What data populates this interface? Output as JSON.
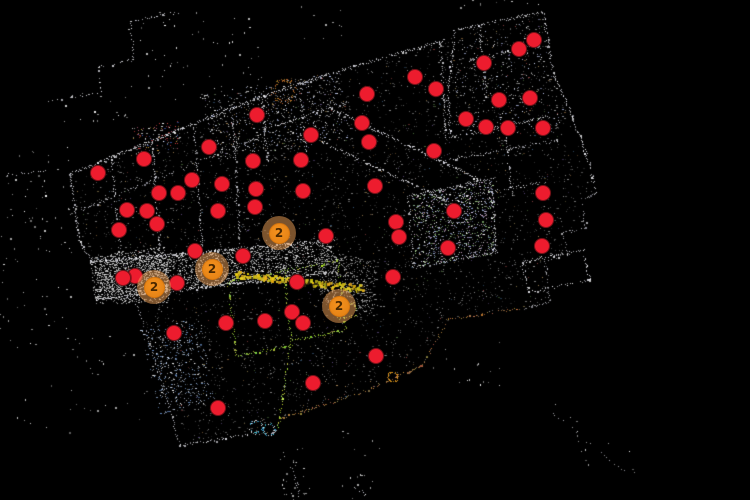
{
  "view": {
    "title": "point-cloud-floor-map",
    "width": 750,
    "height": 500,
    "background_color": "#000000"
  },
  "markers": {
    "poi_fill": "#ed1c2e",
    "poi_border": "#7a1219",
    "cluster_halo": "rgba(246,166,90,0.5)",
    "cluster_fill_inner": "#f6921e",
    "cluster_fill_edge": "#e07f14",
    "cluster_border": "#d8760d",
    "cluster_text_color": "#4a2800",
    "pois": [
      [
        534,
        40
      ],
      [
        519,
        49
      ],
      [
        484,
        63
      ],
      [
        415,
        77
      ],
      [
        436,
        89
      ],
      [
        367,
        94
      ],
      [
        530,
        98
      ],
      [
        499,
        100
      ],
      [
        257,
        115
      ],
      [
        466,
        119
      ],
      [
        362,
        123
      ],
      [
        486,
        127
      ],
      [
        508,
        128
      ],
      [
        543,
        128
      ],
      [
        311,
        135
      ],
      [
        369,
        142
      ],
      [
        209,
        147
      ],
      [
        434,
        151
      ],
      [
        144,
        159
      ],
      [
        301,
        160
      ],
      [
        253,
        161
      ],
      [
        98,
        173
      ],
      [
        192,
        180
      ],
      [
        222,
        184
      ],
      [
        375,
        186
      ],
      [
        256,
        189
      ],
      [
        303,
        191
      ],
      [
        543,
        193
      ],
      [
        159,
        193
      ],
      [
        178,
        193
      ],
      [
        255,
        207
      ],
      [
        454,
        211
      ],
      [
        127,
        210
      ],
      [
        147,
        211
      ],
      [
        218,
        211
      ],
      [
        546,
        220
      ],
      [
        396,
        222
      ],
      [
        157,
        224
      ],
      [
        119,
        230
      ],
      [
        326,
        236
      ],
      [
        399,
        237
      ],
      [
        542,
        246
      ],
      [
        448,
        248
      ],
      [
        195,
        251
      ],
      [
        243,
        256
      ],
      [
        135,
        276
      ],
      [
        123,
        278
      ],
      [
        393,
        277
      ],
      [
        177,
        283
      ],
      [
        297,
        282
      ],
      [
        292,
        312
      ],
      [
        303,
        323
      ],
      [
        226,
        323
      ],
      [
        265,
        321
      ],
      [
        174,
        333
      ],
      [
        313,
        383
      ],
      [
        376,
        356
      ],
      [
        218,
        408
      ]
    ],
    "clusters": [
      {
        "x": 279,
        "y": 233,
        "count": "2"
      },
      {
        "x": 212,
        "y": 269,
        "count": "2"
      },
      {
        "x": 154,
        "y": 287,
        "count": "2"
      },
      {
        "x": 339,
        "y": 306,
        "count": "2"
      }
    ]
  },
  "point_cloud": {
    "seed": 1337,
    "outline": [
      [
        70,
        174
      ],
      [
        255,
        99
      ],
      [
        338,
        71
      ],
      [
        445,
        40
      ],
      [
        455,
        30
      ],
      [
        543,
        12
      ],
      [
        553,
        72
      ],
      [
        572,
        115
      ],
      [
        596,
        195
      ],
      [
        580,
        199
      ],
      [
        586,
        228
      ],
      [
        562,
        233
      ],
      [
        568,
        255
      ],
      [
        545,
        260
      ],
      [
        550,
        302
      ],
      [
        522,
        309
      ],
      [
        448,
        320
      ],
      [
        422,
        366
      ],
      [
        358,
        394
      ],
      [
        280,
        419
      ],
      [
        278,
        431
      ],
      [
        180,
        445
      ],
      [
        158,
        370
      ],
      [
        130,
        284
      ],
      [
        94,
        300
      ],
      [
        90,
        262
      ],
      [
        80,
        242
      ]
    ],
    "walls": [
      {
        "p": [
          [
            70,
            174
          ],
          [
            255,
            99
          ],
          [
            338,
            71
          ],
          [
            445,
            40
          ]
        ],
        "d": 1.3,
        "b": [
          170,
          255
        ]
      },
      {
        "p": [
          [
            70,
            174
          ],
          [
            80,
            242
          ],
          [
            92,
            262
          ]
        ],
        "d": 1.2
      },
      {
        "p": [
          [
            455,
            30
          ],
          [
            543,
            12
          ],
          [
            553,
            72
          ],
          [
            572,
            115
          ],
          [
            590,
            165
          ],
          [
            596,
            195
          ]
        ],
        "d": 1.1
      },
      {
        "p": [
          [
            596,
            195
          ],
          [
            580,
            199
          ],
          [
            586,
            228
          ],
          [
            562,
            233
          ],
          [
            568,
            255
          ],
          [
            545,
            260
          ],
          [
            550,
            302
          ],
          [
            522,
            309
          ]
        ],
        "d": 0.8,
        "b": [
          120,
          210
        ]
      },
      {
        "p": [
          [
            455,
            30
          ],
          [
            448,
            95
          ],
          [
            450,
            138
          ]
        ]
      },
      {
        "p": [
          [
            450,
            138
          ],
          [
            552,
            116
          ]
        ]
      },
      {
        "p": [
          [
            440,
            42
          ],
          [
            446,
            140
          ]
        ],
        "d": 0.9
      },
      {
        "p": [
          [
            438,
            162
          ],
          [
            560,
            140
          ]
        ],
        "d": 0.8
      },
      {
        "p": [
          [
            330,
            108
          ],
          [
            480,
            180
          ]
        ],
        "d": 1.4,
        "b": [
          180,
          255
        ]
      },
      {
        "p": [
          [
            322,
            142
          ],
          [
            462,
            208
          ]
        ],
        "d": 1.2,
        "b": [
          170,
          255
        ]
      },
      {
        "p": [
          [
            90,
            262
          ],
          [
            335,
            240
          ]
        ],
        "d": 1.4,
        "b": [
          180,
          255
        ]
      },
      {
        "p": [
          [
            94,
            300
          ],
          [
            338,
            272
          ]
        ],
        "d": 1.4,
        "b": [
          180,
          255
        ]
      },
      {
        "p": [
          [
            130,
            284
          ],
          [
            158,
            370
          ],
          [
            180,
            445
          ]
        ],
        "d": 0.7,
        "b": [
          130,
          220
        ]
      },
      {
        "p": [
          [
            180,
            445
          ],
          [
            278,
            431
          ]
        ],
        "d": 0.9
      },
      {
        "p": [
          [
            112,
            158
          ],
          [
            120,
            253
          ]
        ],
        "d": 0.9
      },
      {
        "p": [
          [
            152,
            142
          ],
          [
            160,
            250
          ]
        ],
        "d": 0.9
      },
      {
        "p": [
          [
            194,
            125
          ],
          [
            202,
            247
          ]
        ],
        "d": 0.9
      },
      {
        "p": [
          [
            232,
            108
          ],
          [
            240,
            244
          ]
        ],
        "d": 0.9
      },
      {
        "p": [
          [
            75,
            212
          ],
          [
            258,
            138
          ]
        ],
        "d": 0.8,
        "b": [
          130,
          220
        ]
      },
      {
        "p": [
          [
            262,
            100
          ],
          [
            268,
            162
          ]
        ],
        "d": 0.9
      },
      {
        "p": [
          [
            300,
            88
          ],
          [
            306,
            152
          ]
        ],
        "d": 0.8
      },
      {
        "p": [
          [
            262,
            130
          ],
          [
            348,
            102
          ]
        ],
        "d": 0.8
      },
      {
        "p": [
          [
            410,
            196
          ],
          [
            493,
            179
          ]
        ],
        "d": 1.1
      },
      {
        "p": [
          [
            490,
            179
          ],
          [
            497,
            254
          ]
        ],
        "d": 1.0
      },
      {
        "p": [
          [
            412,
            268
          ],
          [
            494,
            252
          ]
        ],
        "d": 0.9
      },
      {
        "p": [
          [
            408,
            196
          ],
          [
            414,
            268
          ]
        ],
        "d": 0.8
      },
      {
        "p": [
          [
            505,
            130
          ],
          [
            512,
            196
          ]
        ],
        "d": 0.8
      },
      {
        "p": [
          [
            460,
            198
          ],
          [
            545,
            182
          ]
        ],
        "d": 0.8
      },
      {
        "p": [
          [
            522,
            262
          ],
          [
            583,
            250
          ],
          [
            590,
            280
          ],
          [
            529,
            292
          ],
          [
            522,
            262
          ]
        ],
        "d": 0.9,
        "b": [
          160,
          255
        ]
      },
      {
        "p": [
          [
            470,
            60
          ],
          [
            540,
            45
          ]
        ],
        "d": 0.7
      },
      {
        "p": [
          [
            480,
            28
          ],
          [
            486,
            100
          ]
        ],
        "d": 0.7
      },
      {
        "p": [
          [
            178,
            12
          ],
          [
            130,
            22
          ],
          [
            134,
            60
          ],
          [
            99,
            67
          ],
          [
            101,
            93
          ],
          [
            48,
            101
          ]
        ],
        "d": 0.55,
        "b": [
          170,
          255
        ]
      },
      {
        "p": [
          [
            5,
            175
          ],
          [
            45,
            171
          ]
        ],
        "d": 0.5
      },
      {
        "p": [
          [
            552,
            412
          ],
          [
            625,
            472
          ]
        ],
        "d": 0.22,
        "b": [
          130,
          220
        ]
      },
      {
        "p": [
          [
            292,
            462
          ],
          [
            300,
            498
          ]
        ],
        "d": 0.5,
        "b": [
          140,
          230
        ]
      },
      {
        "p": [
          [
            355,
            487
          ],
          [
            366,
            494
          ]
        ],
        "d": 0.5
      },
      {
        "p": [
          [
            280,
            419
          ],
          [
            358,
            394
          ],
          [
            422,
            366
          ]
        ],
        "c": "t",
        "d": 1.0
      },
      {
        "p": [
          [
            422,
            366
          ],
          [
            448,
            320
          ],
          [
            520,
            308
          ]
        ],
        "c": "t",
        "d": 0.7
      },
      {
        "p": [
          [
            228,
            282
          ],
          [
            284,
            271
          ],
          [
            292,
            345
          ],
          [
            236,
            356
          ],
          [
            228,
            282
          ]
        ],
        "c": "g",
        "d": 0.9
      },
      {
        "p": [
          [
            284,
            271
          ],
          [
            338,
            261
          ],
          [
            346,
            330
          ],
          [
            292,
            341
          ]
        ],
        "c": "g",
        "d": 0.9
      },
      {
        "p": [
          [
            290,
            347
          ],
          [
            278,
            428
          ]
        ],
        "c": "g",
        "d": 0.9
      },
      {
        "p": [
          [
            337,
            307
          ],
          [
            355,
            303
          ],
          [
            357,
            315
          ],
          [
            339,
            319
          ],
          [
            337,
            307
          ]
        ],
        "c": "g",
        "d": 0.8
      },
      {
        "p": [
          [
            236,
            274
          ],
          [
            363,
            288
          ]
        ],
        "c": "y",
        "w": 3,
        "d": 1.6
      }
    ],
    "arcs": [
      {
        "cx": 284,
        "cy": 91,
        "r": 11,
        "c": "brown",
        "n": 70
      },
      {
        "cx": 393,
        "cy": 377,
        "r": 5,
        "c": "orange",
        "n": 40
      },
      {
        "cx": 256,
        "cy": 427,
        "r": 6,
        "c": "blue",
        "n": 34
      },
      {
        "cx": 269,
        "cy": 430,
        "r": 6,
        "c": "blue",
        "n": 34
      }
    ],
    "regions": [
      {
        "poly": "outline",
        "n": 4200,
        "pal": "interior"
      },
      {
        "poly": [
          [
            90,
            262
          ],
          [
            335,
            240
          ],
          [
            338,
            272
          ],
          [
            94,
            300
          ]
        ],
        "n": 2000,
        "pal": "bright"
      },
      {
        "poly": [
          [
            92,
            256
          ],
          [
            165,
            246
          ],
          [
            170,
            303
          ],
          [
            96,
            304
          ]
        ],
        "n": 800,
        "pal": "bright"
      },
      {
        "poly": [
          [
            320,
            250
          ],
          [
            378,
            262
          ],
          [
            374,
            316
          ],
          [
            318,
            300
          ]
        ],
        "n": 420,
        "pal": "mid"
      },
      {
        "poly": [
          [
            412,
            196
          ],
          [
            493,
            179
          ],
          [
            497,
            254
          ],
          [
            416,
            268
          ]
        ],
        "n": 850,
        "pal": "garden"
      },
      {
        "poly": [
          [
            200,
            95
          ],
          [
            340,
            70
          ],
          [
            350,
            140
          ],
          [
            215,
            160
          ]
        ],
        "n": 650,
        "pal": "mixbright"
      },
      {
        "poly": [
          [
            140,
            330
          ],
          [
            200,
            318
          ],
          [
            215,
            400
          ],
          [
            160,
            415
          ]
        ],
        "n": 420,
        "pal": "bluish"
      },
      {
        "poly": [
          [
            132,
            128
          ],
          [
            178,
            120
          ],
          [
            182,
            148
          ],
          [
            136,
            155
          ]
        ],
        "n": 110,
        "pal": "colorful"
      },
      {
        "poly": [
          [
            458,
            34
          ],
          [
            540,
            16
          ],
          [
            550,
            70
          ],
          [
            566,
            112
          ],
          [
            556,
            134
          ],
          [
            452,
            134
          ]
        ],
        "n": 380,
        "pal": "mixbright"
      }
    ],
    "debris": [
      [
        125,
        8,
        140,
        92,
        60
      ],
      [
        0,
        140,
        75,
        190,
        80
      ],
      [
        10,
        330,
        140,
        105,
        40
      ],
      [
        555,
        400,
        85,
        80,
        14
      ],
      [
        280,
        448,
        30,
        52,
        30
      ],
      [
        340,
        430,
        40,
        70,
        18
      ],
      [
        430,
        340,
        70,
        50,
        16
      ],
      [
        290,
        5,
        55,
        35,
        10
      ],
      [
        440,
        0,
        120,
        14,
        10
      ],
      [
        60,
        85,
        70,
        40,
        18
      ]
    ],
    "palettes": {
      "accent": [
        "#7a5a36",
        "#3a5a7a",
        "#4a6a3a",
        "#8a4040",
        "#8a7a4a",
        "#5a4a7a",
        "#a88858"
      ],
      "garden": [
        "#cfc8ea",
        "#ffffff",
        "#9fb0d8",
        "#7fae6a",
        "#c8a0c0",
        "#8898c8",
        "#b8e0a0"
      ],
      "bluish": [
        "#9ab8e0",
        "#cdd8ee",
        "#ffffff",
        "#6a90c8",
        "#808890"
      ],
      "colorful": [
        "#d04040",
        "#e0e0e0",
        "#4060c0",
        "#d0a040",
        "#ffffff",
        "#c06080"
      ]
    }
  }
}
